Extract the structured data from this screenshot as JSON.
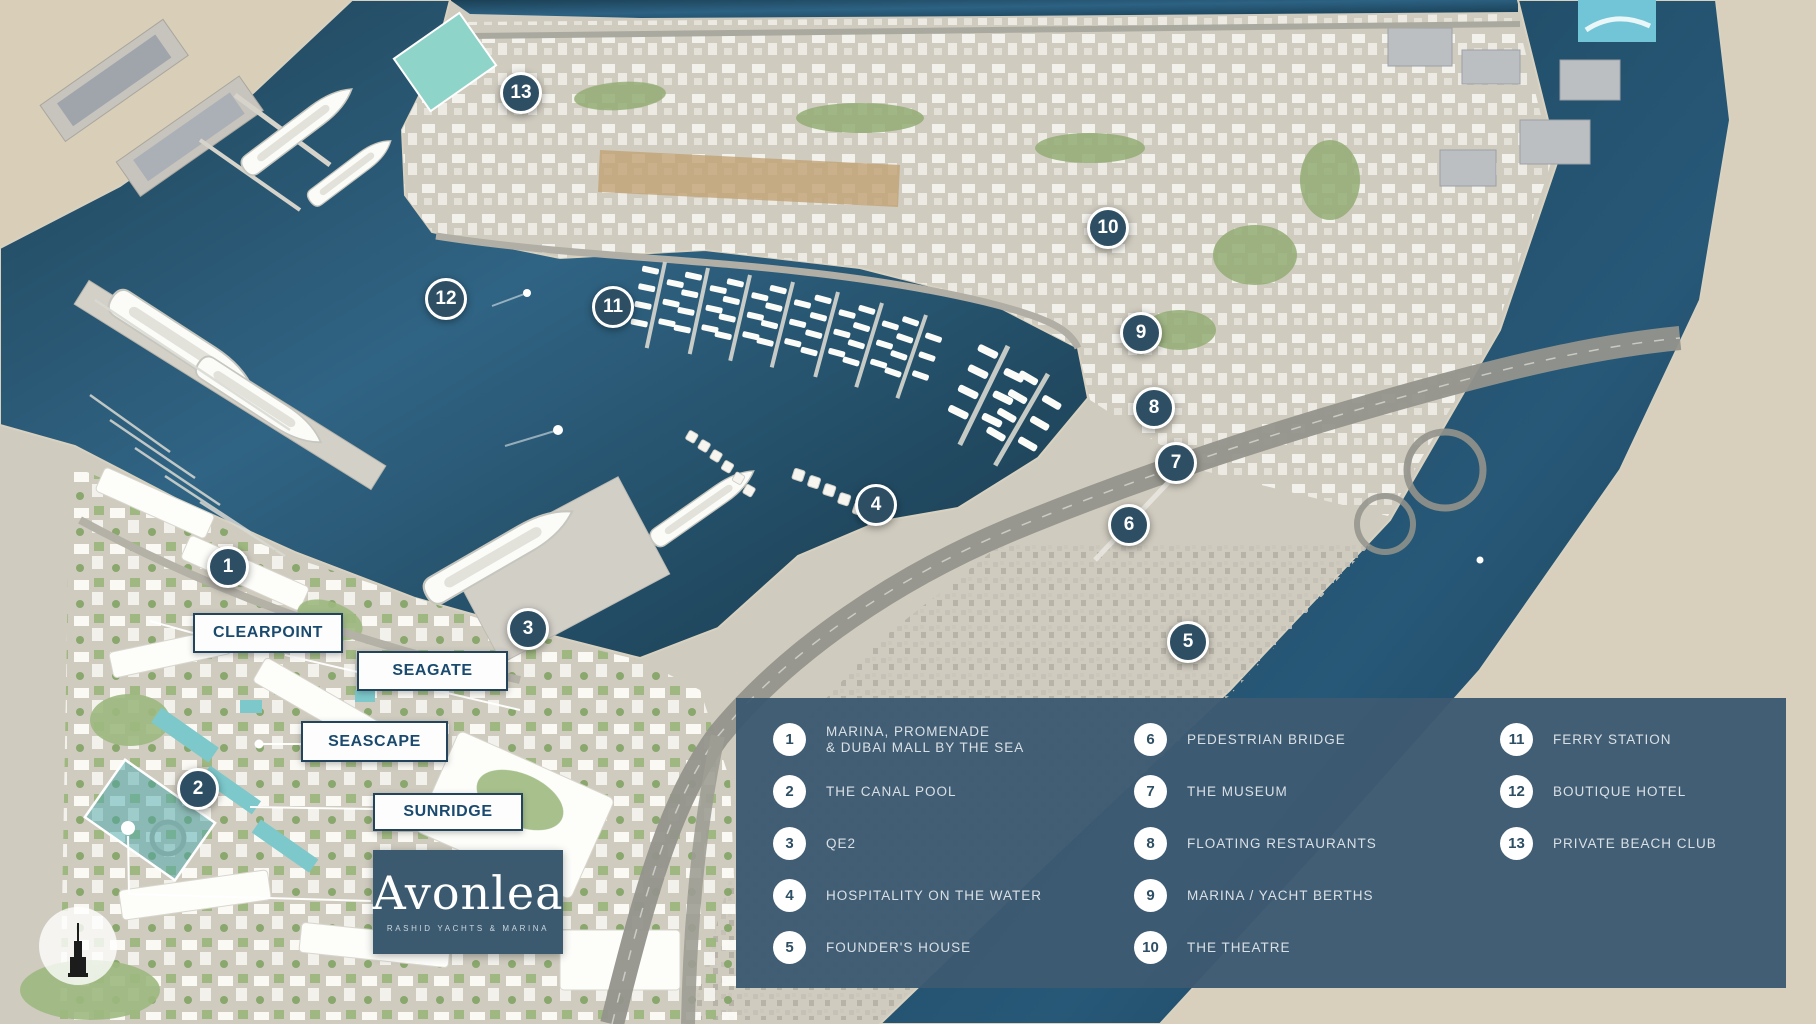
{
  "branding": {
    "logo_text": "Avonlea",
    "logo_subtitle": "RASHID YACHTS & MARINA"
  },
  "colors": {
    "legend_panel": "#3d5a72",
    "marker_fill": "#2d4e63",
    "marker_border": "#ffffff",
    "area_label_text": "#1a4a6e",
    "area_label_border": "#24435c",
    "legend_text": "#d9e0e6",
    "water": "#1b4258",
    "land": "#cfcbbf"
  },
  "area_labels": [
    {
      "label": "CLEARPOINT",
      "x": 193,
      "y": 613,
      "w": 150,
      "h": 40
    },
    {
      "label": "SEAGATE",
      "x": 357,
      "y": 651,
      "w": 151,
      "h": 40
    },
    {
      "label": "SEASCAPE",
      "x": 301,
      "y": 721,
      "w": 147,
      "h": 41
    },
    {
      "label": "SUNRIDGE",
      "x": 373,
      "y": 793,
      "w": 150,
      "h": 38
    }
  ],
  "map_markers": [
    {
      "number": "1",
      "x": 228,
      "y": 567,
      "label": "MARINA, PROMENADE & DUBAI MALL BY THE SEA"
    },
    {
      "number": "2",
      "x": 198,
      "y": 789,
      "label": "THE CANAL POOL"
    },
    {
      "number": "3",
      "x": 528,
      "y": 629,
      "label": "QE2"
    },
    {
      "number": "4",
      "x": 876,
      "y": 505,
      "label": "HOSPITALITY ON THE WATER"
    },
    {
      "number": "5",
      "x": 1188,
      "y": 642,
      "label": "FOUNDER'S HOUSE"
    },
    {
      "number": "6",
      "x": 1129,
      "y": 525,
      "label": "PEDESTRIAN BRIDGE"
    },
    {
      "number": "7",
      "x": 1176,
      "y": 463,
      "label": "THE MUSEUM"
    },
    {
      "number": "8",
      "x": 1154,
      "y": 408,
      "label": "FLOATING RESTAURANTS"
    },
    {
      "number": "9",
      "x": 1141,
      "y": 333,
      "label": "MARINA / YACHT BERTHS"
    },
    {
      "number": "10",
      "x": 1108,
      "y": 228,
      "label": "THE THEATRE"
    },
    {
      "number": "11",
      "x": 613,
      "y": 307,
      "label": "FERRY STATION"
    },
    {
      "number": "12",
      "x": 446,
      "y": 299,
      "label": "BOUTIQUE HOTEL"
    },
    {
      "number": "13",
      "x": 521,
      "y": 93,
      "label": "PRIVATE BEACH CLUB"
    }
  ],
  "legend": {
    "columns": [
      [
        {
          "number": "1",
          "label": "MARINA, PROMENADE",
          "label2": "& DUBAI MALL BY THE SEA"
        },
        {
          "number": "2",
          "label": "THE CANAL POOL"
        },
        {
          "number": "3",
          "label": "QE2"
        },
        {
          "number": "4",
          "label": "HOSPITALITY ON THE WATER"
        },
        {
          "number": "5",
          "label": "FOUNDER'S HOUSE"
        }
      ],
      [
        {
          "number": "6",
          "label": "PEDESTRIAN BRIDGE"
        },
        {
          "number": "7",
          "label": "THE MUSEUM"
        },
        {
          "number": "8",
          "label": "FLOATING RESTAURANTS"
        },
        {
          "number": "9",
          "label": "MARINA / YACHT BERTHS"
        },
        {
          "number": "10",
          "label": "THE THEATRE"
        }
      ],
      [
        {
          "number": "11",
          "label": "FERRY STATION"
        },
        {
          "number": "12",
          "label": "BOUTIQUE HOTEL"
        },
        {
          "number": "13",
          "label": "PRIVATE BEACH CLUB"
        }
      ]
    ]
  }
}
